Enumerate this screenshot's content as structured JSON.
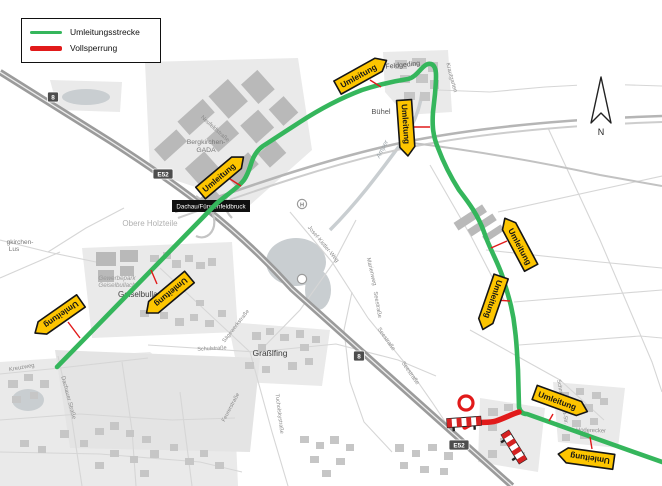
{
  "legend": {
    "items": [
      {
        "label": "Umleitungsstrecke",
        "color": "#35b65c",
        "thickness": 3
      },
      {
        "label": "Vollsperrung",
        "color": "#e11a1a",
        "thickness": 5
      }
    ]
  },
  "compass": {
    "label": "N"
  },
  "routes": {
    "detour": {
      "name": "Umleitungsstrecke",
      "color": "#35b65c",
      "path": "M57,367 L215,205 C223,197 237,189 244,180 C248,174 249,170 251,164 C253,157 256,151 263,146 L300,122 C320,109 341,98 362,90 C380,84 395,81 408,79 C418,77 423,62 431,64 C438,66 436,80 435,94 L433,112 C432,126 433,136 438,148 C444,164 452,179 459,190 C469,203 478,215 484,232 C490,250 498,262 503,278 C508,295 513,309 515,330 C517,345 517,355 518,370 L519,407 C520,412 523,414 527,414 L662,462"
    },
    "closure": {
      "name": "Vollsperrung",
      "color": "#e11a1a",
      "path": "M465,427 C474,420 486,424 496,421 C505,418 512,414 519,412"
    }
  },
  "detour_signs": {
    "label": "Umleitung",
    "color": "#fdc500",
    "placements": [
      {
        "x": 362,
        "y": 74,
        "r": -29,
        "tip": "right"
      },
      {
        "x": 406,
        "y": 128,
        "r": 86,
        "tip": "right"
      },
      {
        "x": 222,
        "y": 175,
        "r": -40,
        "tip": "right"
      },
      {
        "x": 168,
        "y": 295,
        "r": 140,
        "tip": "right"
      },
      {
        "x": 58,
        "y": 317,
        "r": 145,
        "tip": "right"
      },
      {
        "x": 518,
        "y": 243,
        "r": 62,
        "tip": "left"
      },
      {
        "x": 492,
        "y": 303,
        "r": 109,
        "tip": "right"
      },
      {
        "x": 561,
        "y": 402,
        "r": 20,
        "tip": "right"
      },
      {
        "x": 586,
        "y": 458,
        "r": -172,
        "tip": "right"
      }
    ],
    "leaders": [
      [
        370,
        80,
        381,
        87
      ],
      [
        413,
        127,
        430,
        127
      ],
      [
        230,
        179,
        241,
        186
      ],
      [
        157,
        284,
        151,
        270
      ],
      [
        68,
        322,
        80,
        338
      ],
      [
        507,
        241,
        491,
        248
      ],
      [
        495,
        300,
        510,
        301
      ],
      [
        553,
        414,
        549,
        421
      ],
      [
        592,
        449,
        590,
        437
      ]
    ]
  },
  "closure_icons": {
    "circle": {
      "x": 466,
      "y": 403,
      "r": 7
    },
    "barriers": [
      {
        "x": 464,
        "y": 422,
        "r": -4
      },
      {
        "x": 514,
        "y": 447,
        "r": 58
      }
    ]
  },
  "shields": [
    {
      "text": "8",
      "x": 53,
      "y": 97
    },
    {
      "text": "E52",
      "x": 163,
      "y": 174
    },
    {
      "text": "8",
      "x": 359,
      "y": 356
    },
    {
      "text": "E52",
      "x": 459,
      "y": 445
    }
  ],
  "exit_label": {
    "text": "Dachau/Fürstenfeldbruck",
    "x": 172,
    "y": 200
  },
  "poi": [
    {
      "text": "H",
      "x": 302,
      "y": 204
    },
    {
      "text": "",
      "x": 302,
      "y": 279
    }
  ],
  "map_labels": [
    {
      "t": "Feldgeding",
      "x": 403,
      "y": 67,
      "r": -6,
      "s": 7,
      "c": "#555555"
    },
    {
      "t": "Bühel",
      "x": 381,
      "y": 114,
      "r": 0,
      "s": 7.5,
      "c": "#555555"
    },
    {
      "t": "Bergkirchen-",
      "x": 206,
      "y": 144,
      "r": 0,
      "s": 6.8,
      "c": "#777777"
    },
    {
      "t": "GADA",
      "x": 206,
      "y": 152,
      "r": 0,
      "s": 6.8,
      "c": "#777777"
    },
    {
      "t": "Obere Holzteile",
      "x": 150,
      "y": 226,
      "r": 0,
      "s": 8,
      "c": "#b0b0b0"
    },
    {
      "t": "Gewerbepark",
      "x": 117,
      "y": 280,
      "r": 0,
      "s": 6.2,
      "c": "#999999",
      "i": 1
    },
    {
      "t": "Geiselbullach",
      "x": 117,
      "y": 287,
      "r": 0,
      "s": 6.2,
      "c": "#999999",
      "i": 1
    },
    {
      "t": "Geiselbullach",
      "x": 142,
      "y": 297,
      "r": 0,
      "s": 8,
      "c": "#3c3c3c"
    },
    {
      "t": "Graßlfing",
      "x": 270,
      "y": 356,
      "r": 0,
      "s": 8.5,
      "c": "#3c3c3c"
    },
    {
      "t": "Schulstraße",
      "x": 212,
      "y": 350,
      "r": -3,
      "s": 5.5,
      "c": "#8a8a8a"
    },
    {
      "t": "Sägewerkstraße",
      "x": 237,
      "y": 327,
      "r": -52,
      "s": 5.5,
      "c": "#8a8a8a"
    },
    {
      "t": "Feurerstraße",
      "x": 232,
      "y": 408,
      "r": -62,
      "s": 5.5,
      "c": "#8a8a8a"
    },
    {
      "t": "Tucholskystraße",
      "x": 278,
      "y": 414,
      "r": 83,
      "s": 5.5,
      "c": "#8a8a8a"
    },
    {
      "t": "Amper",
      "x": 384,
      "y": 150,
      "r": -62,
      "s": 6.5,
      "c": "#9aa3a8",
      "i": 1
    },
    {
      "t": "Josef-Kistler-Weg",
      "x": 322,
      "y": 245,
      "r": 50,
      "s": 5.8,
      "c": "#8a8a8a"
    },
    {
      "t": "Marienweg",
      "x": 370,
      "y": 272,
      "r": 77,
      "s": 5.8,
      "c": "#8a8a8a"
    },
    {
      "t": "Seestraße",
      "x": 376,
      "y": 305,
      "r": 80,
      "s": 5.8,
      "c": "#8a8a8a"
    },
    {
      "t": "Seestraße",
      "x": 385,
      "y": 340,
      "r": 55,
      "s": 5.8,
      "c": "#8a8a8a"
    },
    {
      "t": "Seestraße",
      "x": 409,
      "y": 374,
      "r": 55,
      "s": 5.8,
      "c": "#8a8a8a"
    },
    {
      "t": "Hoderecker",
      "x": 591,
      "y": 432,
      "r": 2,
      "s": 5.8,
      "c": "#8a8a8a"
    },
    {
      "t": "Dachauer Straße",
      "x": 67,
      "y": 398,
      "r": 75,
      "s": 5.8,
      "c": "#8a8a8a"
    },
    {
      "t": "Kreuzweg",
      "x": 22,
      "y": 369,
      "r": -10,
      "s": 5.8,
      "c": "#8a8a8a"
    },
    {
      "t": "gkirchen-",
      "x": 20,
      "y": 244,
      "r": 0,
      "s": 6.5,
      "c": "#777777"
    },
    {
      "t": "Lus",
      "x": 14,
      "y": 251,
      "r": 0,
      "s": 6.5,
      "c": "#777777"
    },
    {
      "t": "Neufeldstraße",
      "x": 214,
      "y": 130,
      "r": 42,
      "s": 5.8,
      "c": "#8a8a8a"
    },
    {
      "t": "Krautgarten",
      "x": 450,
      "y": 78,
      "r": 75,
      "s": 5.8,
      "c": "#8a8a8a"
    },
    {
      "t": "Schmid-Perret-Str.",
      "x": 561,
      "y": 402,
      "r": 80,
      "s": 5.5,
      "c": "#8a8a8a"
    }
  ]
}
